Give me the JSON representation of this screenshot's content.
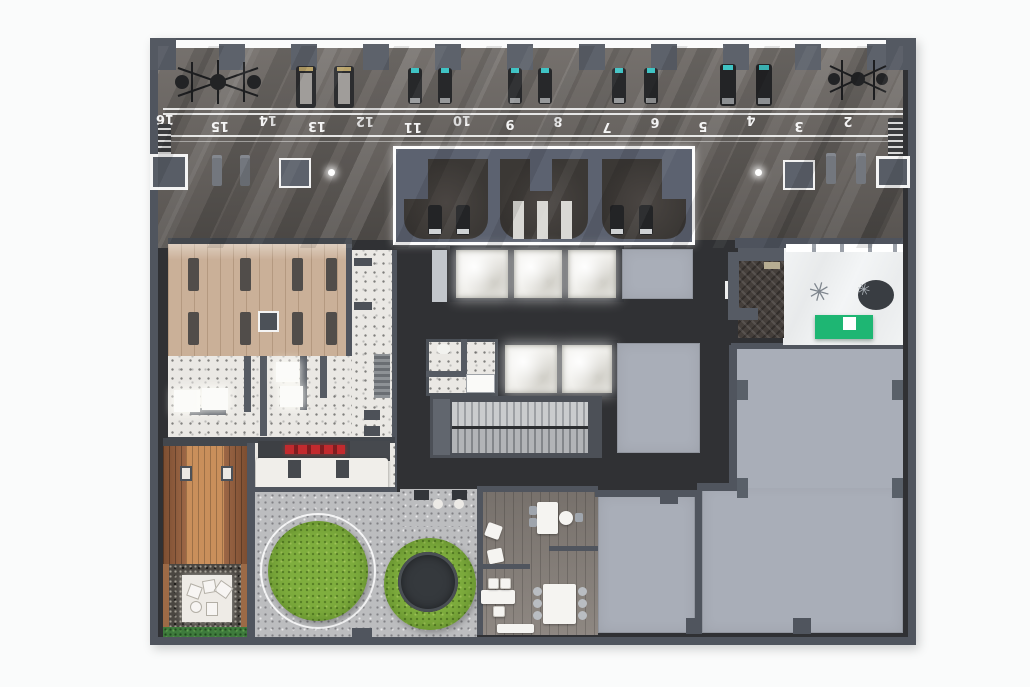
{
  "floor_plan": {
    "description": "Amenity floor plan rendering: fitness hall with numbered running track, studios, elevators, locker rooms, lobby with reception desk, outdoor terrace with lawn circles, lounge and empty lease spaces",
    "track_lane_numbers": [
      "16",
      "15",
      "14",
      "13",
      "12",
      "11",
      "10",
      "9",
      "8",
      "7",
      "6",
      "5",
      "4",
      "3",
      "2"
    ],
    "colors": {
      "wall": "#50555e",
      "gym_floor": "#6b6662",
      "core_floor": "#303134",
      "wood_studio_floor": "#cab098",
      "terrazzo_floor": "#eae8e4",
      "marble_lobby_floor": "#eef0f1",
      "reception_desk_green": "#1eb673",
      "grass_green": "#7fae3e",
      "paving_gray": "#bcbdbf",
      "deck_wood": "#ad6c44",
      "hedge_green": "#3e7b3c",
      "empty_room_gray": "#a9aeb8",
      "bar_stool_red": "#c22a2e",
      "elevator_car_white": "#efeeea",
      "track_line_white": "#f4f4f4",
      "cardio_screen_teal": "#3fc3c4"
    }
  }
}
